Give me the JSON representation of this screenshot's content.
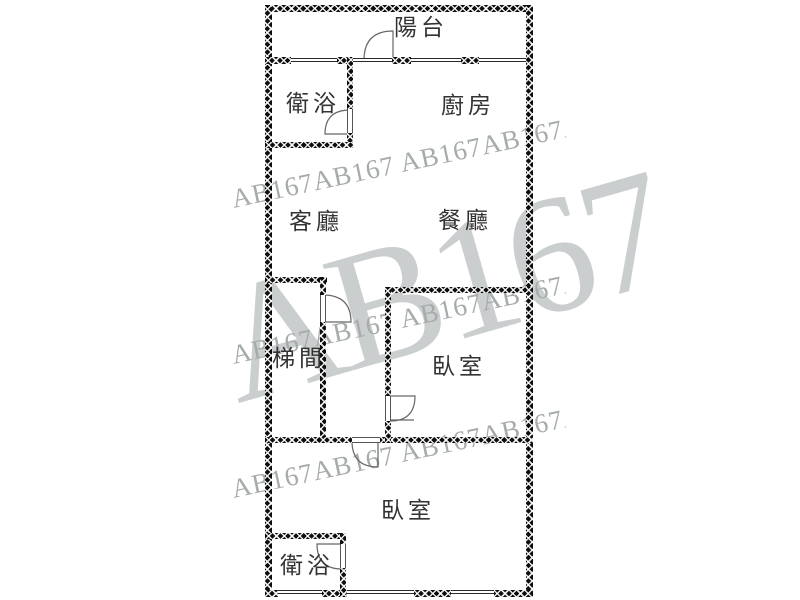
{
  "plan": {
    "type": "apartment-floor-plan",
    "rooms": [
      {
        "id": "balcony",
        "label": "陽台"
      },
      {
        "id": "bathroom-top",
        "label": "衛浴"
      },
      {
        "id": "kitchen",
        "label": "廚房"
      },
      {
        "id": "living-room",
        "label": "客廳"
      },
      {
        "id": "dining-room",
        "label": "餐廳"
      },
      {
        "id": "stairwell",
        "label": "梯間"
      },
      {
        "id": "bedroom-upper",
        "label": "臥室"
      },
      {
        "id": "bedroom-lower",
        "label": "臥室"
      },
      {
        "id": "bathroom-bottom",
        "label": "衛浴"
      }
    ]
  },
  "watermark": {
    "brand": "AB167",
    "big_text": "AB167",
    "row_text": "AB167AB167 AB167AB167AB167 AB167AB167AB1",
    "row_color": "#a6abab",
    "big_color": "#cbcecf"
  },
  "colors": {
    "background": "#ffffff",
    "wall": "#0e0e0e",
    "label_text": "#333333",
    "door_line": "#666666",
    "thin_line": "#2a2a2a"
  }
}
